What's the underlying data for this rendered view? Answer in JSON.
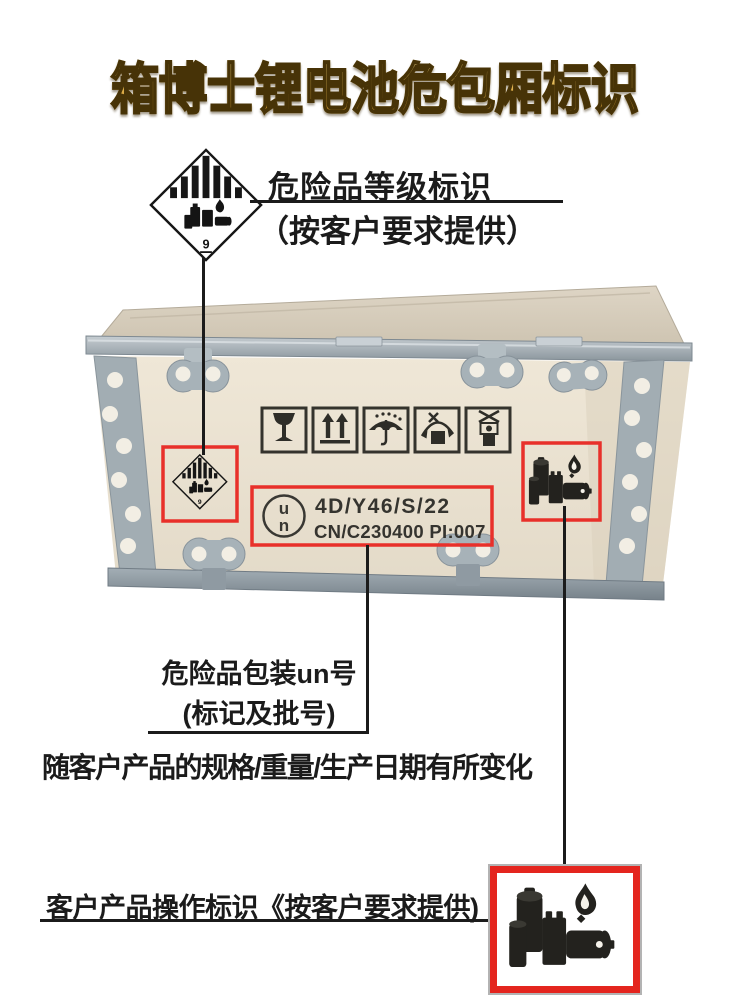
{
  "page": {
    "background": "#ffffff"
  },
  "title": {
    "text": "箱博士锂电池危包厢标识",
    "gold_top": "#f8e7ad",
    "gold_bottom": "#b98726",
    "outline": "#473307"
  },
  "callouts": {
    "hazard": {
      "line1": "危险品等级标识",
      "line2": "（按客户要求提供）"
    },
    "un": {
      "line1": "危险品包装un号",
      "line2": "(标记及批号)"
    },
    "variation_note": "随客户产品的规格/重量/生产日期有所变化",
    "customer": {
      "text": "客户产品操作标识《按客户要求提供)"
    }
  },
  "class9_label": {
    "digit": "9",
    "icon": "class9-lithium-battery-diamond-icon"
  },
  "crate": {
    "un_marking": {
      "circle_top": "u",
      "circle_bottom": "n",
      "line1": "4D/Y46/S/22",
      "line2": "CN/C230400 PI:007"
    },
    "handling_mark_icons": [
      "fragile-icon",
      "this-way-up-icon",
      "keep-dry-icon",
      "do-not-roll-icon",
      "do-not-stack-icon"
    ],
    "battery_label_icon": "lithium-battery-cluster-icon"
  },
  "colors": {
    "highlight_red": "#e8302a",
    "annotation_line": "#1b1b1b",
    "plywood_front": "#ece4d4",
    "plywood_top": "#d8cfbe",
    "metal": "#9aa5ab"
  }
}
